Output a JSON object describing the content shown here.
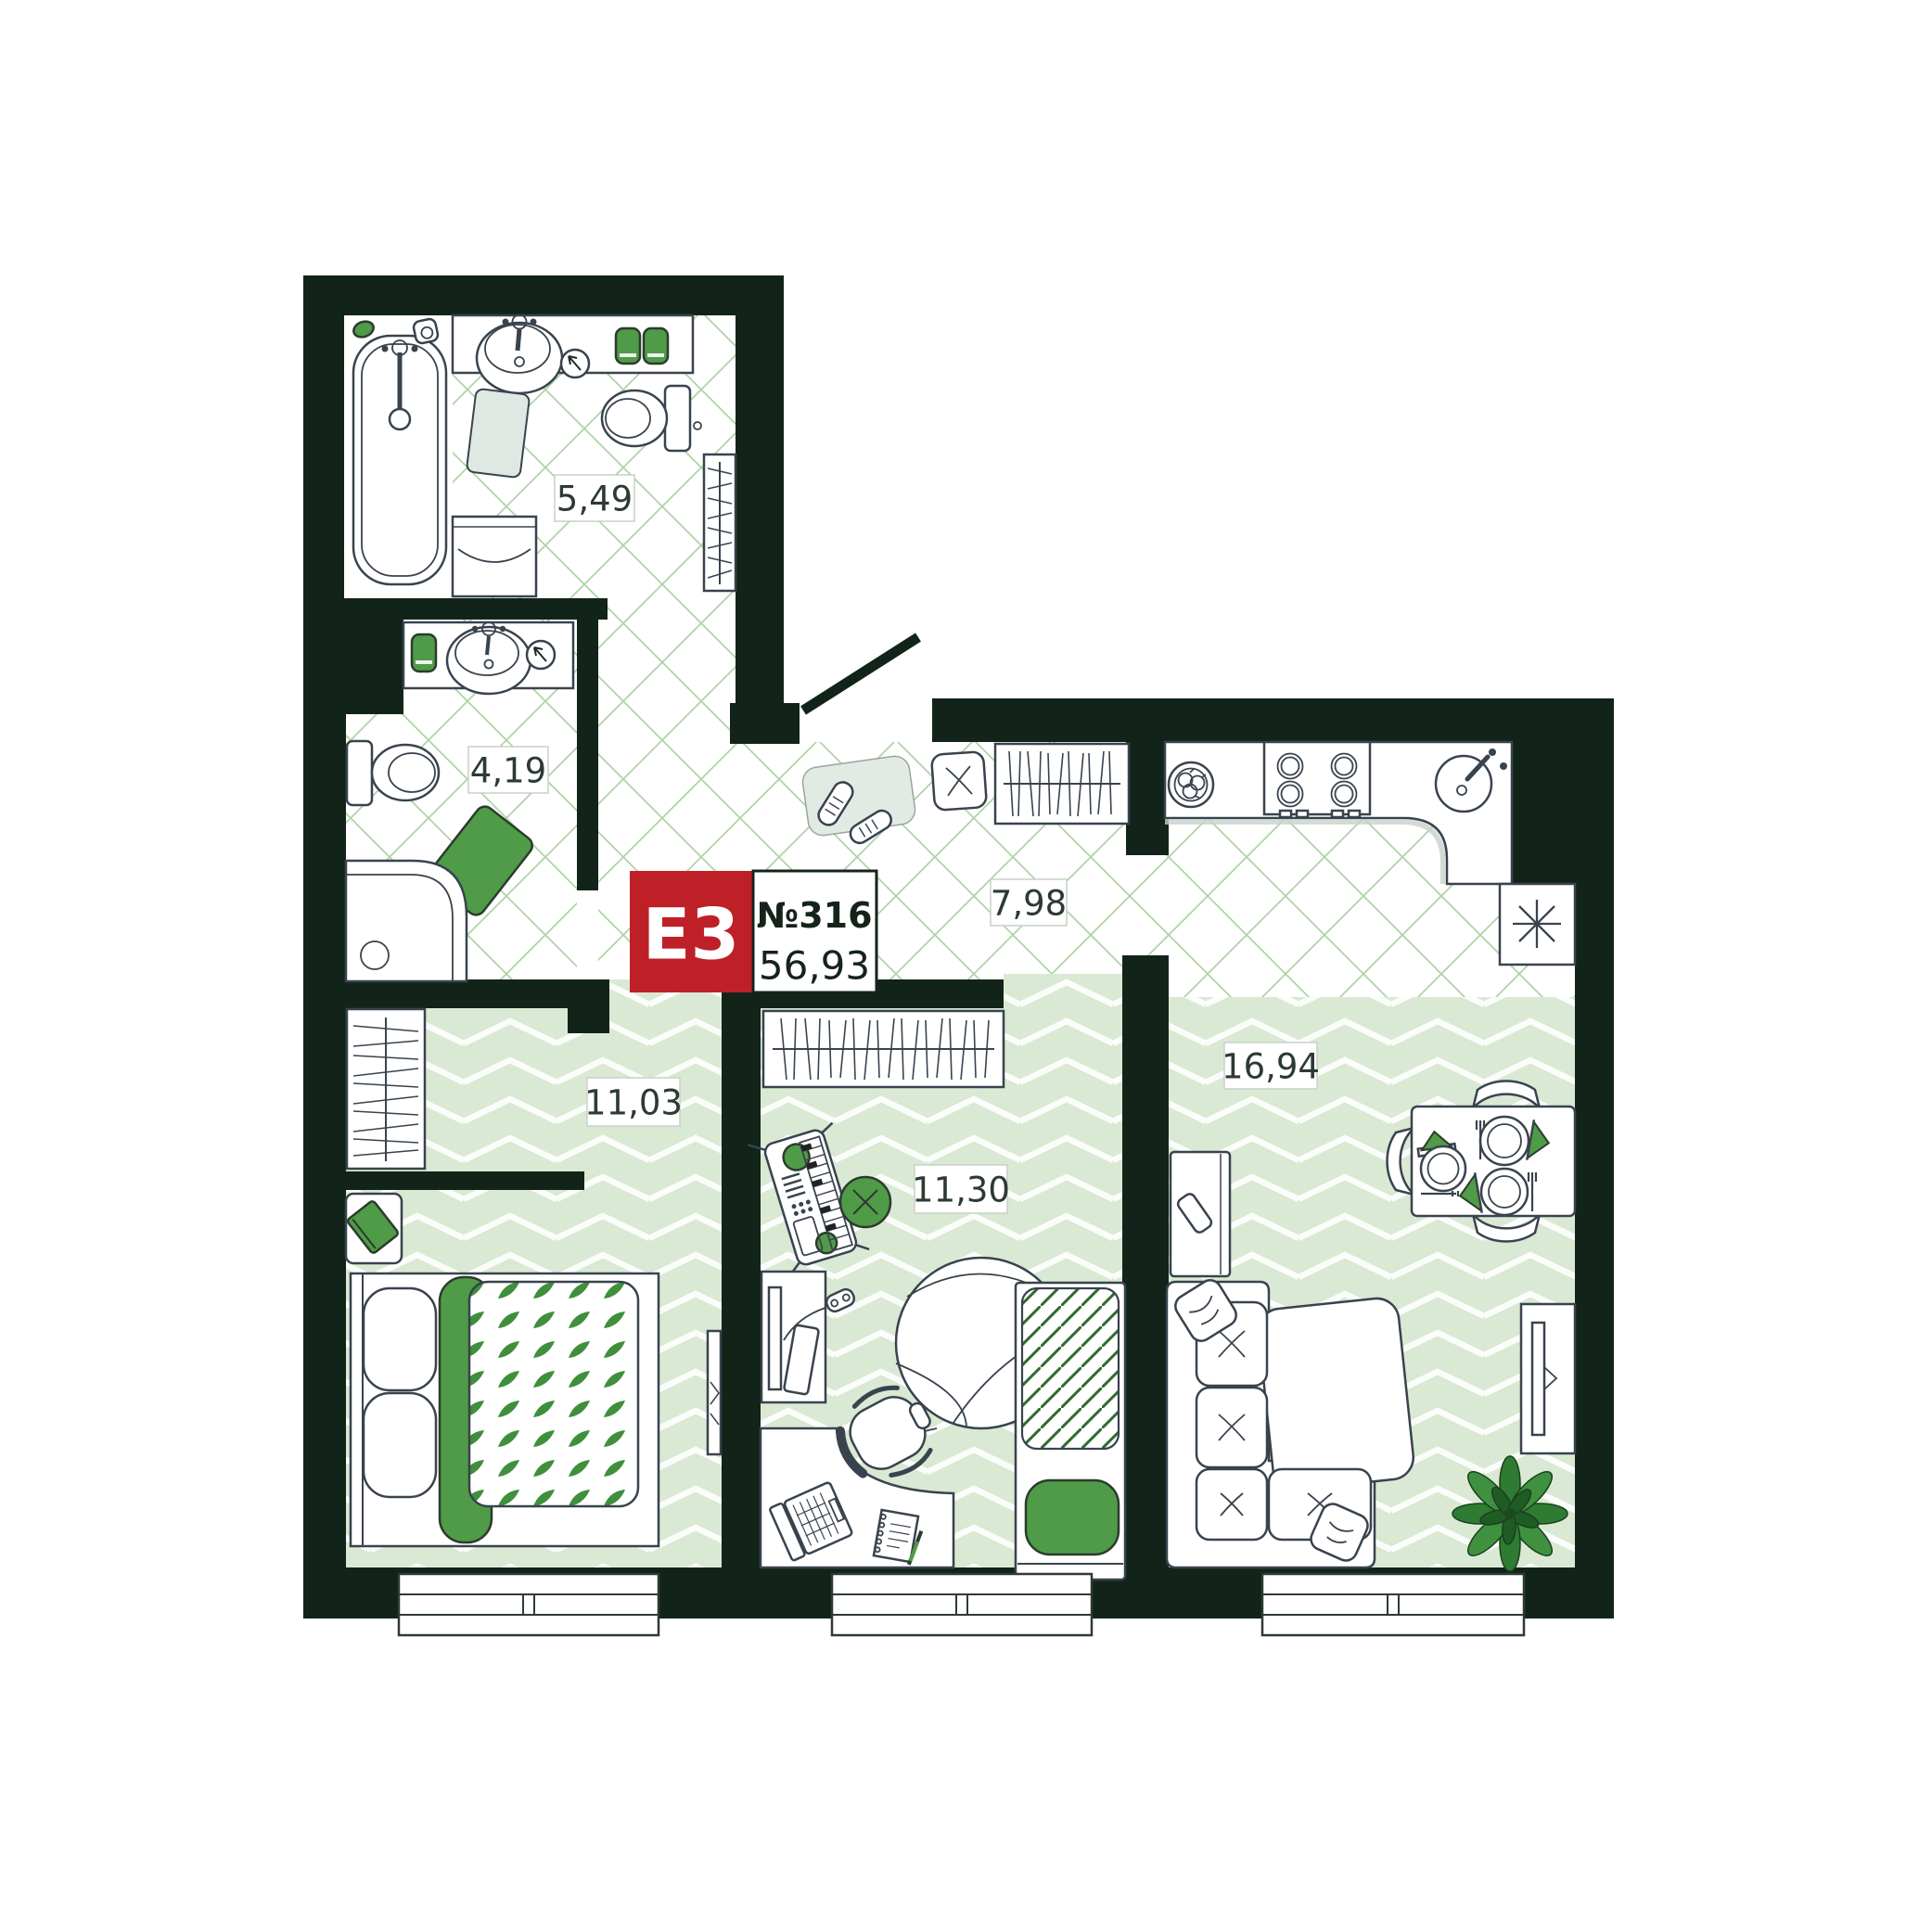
{
  "badge": {
    "type": "Е3",
    "number": "№316",
    "total_area": "56,93"
  },
  "rooms": {
    "bathroom": {
      "name": "bathroom",
      "area": "5,49"
    },
    "toilet": {
      "name": "toilet",
      "area": "4,19"
    },
    "hallway": {
      "name": "hallway",
      "area": "7,98"
    },
    "bedroom": {
      "name": "bedroom",
      "area": "11,03"
    },
    "kids_room": {
      "name": "kids-room",
      "area": "11,30"
    },
    "living_kitchen": {
      "name": "living-kitchen",
      "area": "16,94"
    }
  },
  "colors": {
    "wall": "#122419",
    "badge_red": "#bf2027",
    "accent_green": "#4f9b48",
    "tile_line": "#b0d4a8",
    "herringbone": "#d9e9d4",
    "outline": "#39434e",
    "label_text": "#2c3a34"
  },
  "furniture_icons": [
    "bathtub-icon",
    "sink-icon",
    "toilet-icon",
    "washing-machine-icon",
    "drying-rack-icon",
    "towel-icon",
    "mirror-icon",
    "shower-tray-icon",
    "bath-mat-icon",
    "entry-door-icon",
    "shoe-mat-icon",
    "sneakers-icon",
    "stool-icon",
    "coat-rack-icon",
    "kitchen-counter-icon",
    "stove-icon",
    "kitchen-sink-icon",
    "fruit-plate-icon",
    "vent-table-icon",
    "wardrobe-icon",
    "nightstand-icon",
    "double-bed-icon",
    "tall-mirror-icon",
    "keyboard-synth-icon",
    "tv-stand-icon",
    "gamepad-icon",
    "beanbag-icon",
    "single-bed-icon",
    "desk-icon",
    "laptop-icon",
    "notepad-icon",
    "office-chair-icon",
    "fridge-icon",
    "dining-table-icon",
    "dining-chair-icon",
    "corner-sofa-icon",
    "pillow-icon",
    "tv-panel-icon",
    "plant-icon",
    "window-icon"
  ]
}
